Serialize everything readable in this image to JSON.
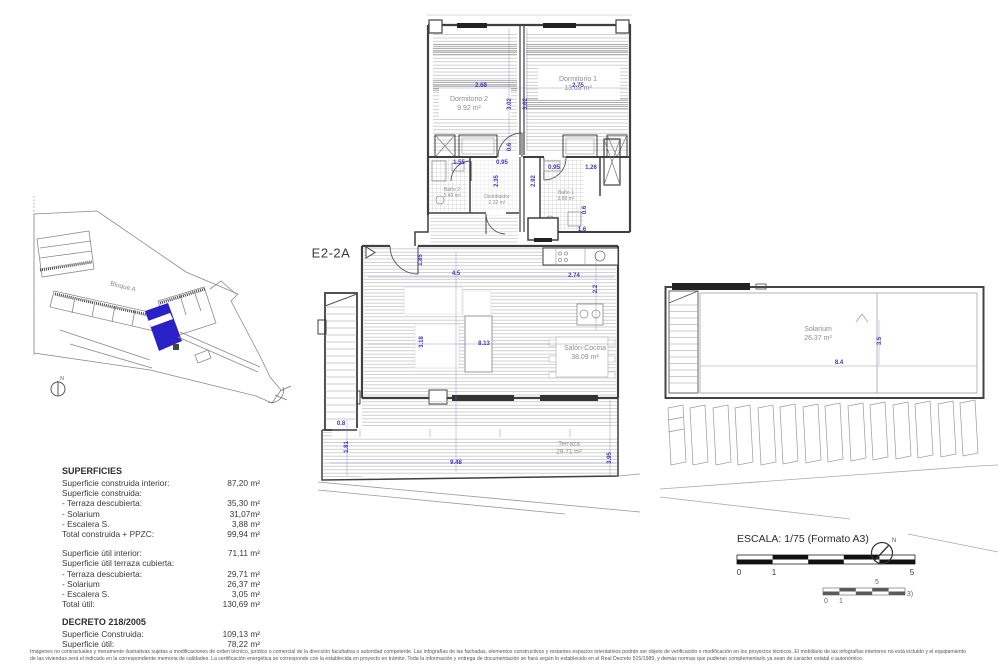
{
  "unit_code": "E2-2A",
  "site_plan": {
    "block_label": "Bloque A",
    "north_label": "N",
    "highlight_color": "#2B21C9"
  },
  "plan": {
    "dim_color": "#3B36C0",
    "rooms": [
      {
        "name": "Dormitorio 2",
        "area": "9.92 m²"
      },
      {
        "name": "Dormitorio 1",
        "area": "13.03 m²"
      },
      {
        "name": "Baño 2",
        "area": "3.40 m²"
      },
      {
        "name": "Distribuidor",
        "area": "2.32 m²"
      },
      {
        "name": "Baño 1",
        "area": "3.89 m²"
      },
      {
        "name": "Salón-Cocina",
        "area": "38.09 m²"
      },
      {
        "name": "Terraza",
        "area": "29.71 m²"
      },
      {
        "name": "Solarium",
        "area": "26.37 m²"
      }
    ],
    "dims": [
      "2.68",
      "2.75",
      "3.02",
      "3.02",
      "0.6",
      "1.55",
      "0.95",
      "2.35",
      "2.92",
      "0.95",
      "1.26",
      "0.6",
      "1.6",
      "1.85",
      "4.5",
      "2.74",
      "2.2",
      "3.18",
      "8.13",
      "0.8",
      "1.81",
      "9.48",
      "3.95",
      "8.4",
      "3.5"
    ]
  },
  "superficies": {
    "title": "SUPERFICIES",
    "rows": [
      {
        "label": "Superficie construida interior:",
        "value": "87,20 m²"
      },
      {
        "label": "Superficie construida:",
        "value": ""
      },
      {
        "label": "- Terraza descubierta:",
        "value": "35,30 m²"
      },
      {
        "label": "- Solarium",
        "value": "31,07m²"
      },
      {
        "label": "- Escalera S.",
        "value": "3,88 m²"
      },
      {
        "label": "Total construida + PPZC:",
        "value": "99,94 m²"
      },
      {
        "label": "Superficie útil interior:",
        "value": "71,11 m²"
      },
      {
        "label": "Superficie útil terraza cubierta:",
        "value": ""
      },
      {
        "label": "- Terraza descubierta:",
        "value": "29,71 m²"
      },
      {
        "label": "- Solarium",
        "value": "26,37 m²"
      },
      {
        "label": "- Escalera S.",
        "value": "3,05 m²"
      },
      {
        "label": "Total útil:",
        "value": "130,69 m²"
      }
    ],
    "decreto_title": "DECRETO 218/2005",
    "decreto_rows": [
      {
        "label": "Superficie Construida:",
        "value": "109,13 m²"
      },
      {
        "label": "Superficie útil:",
        "value": "78,22 m²"
      }
    ]
  },
  "scale": {
    "label": "ESCALA: 1/75 (Formato A3)",
    "ticks": [
      "0",
      "1",
      "5"
    ],
    "ghost_ticks": [
      "0",
      "1",
      "5",
      "3)"
    ],
    "north_label": "N"
  },
  "disclaimer": {
    "line1": "Imágenes no contractuales y meramente ilustrativas sujetas a modificaciones de orden técnico, jurídico o comercial de la dirección facultativa o autoridad competente.  Las infografías de las fachadas, elementos constructivos y restantes espacios orientativos podrán ser objeto de verificación o modificación en los proyectos técnicos.  El mobiliario de las infografías interiores no está incluido y el equipamiento",
    "line2": "de las viviendas será el indicado en la correspondiente memoria de calidades.  La certificación energética se corresponde con la establecida en proyecto en trámite.  Toda la información y entrega de documentación se hará según lo establecido en el Real Decreto 515/1989, y demás normas que pudieran complementarlo ya sean de carácter estatal o autonómico."
  }
}
